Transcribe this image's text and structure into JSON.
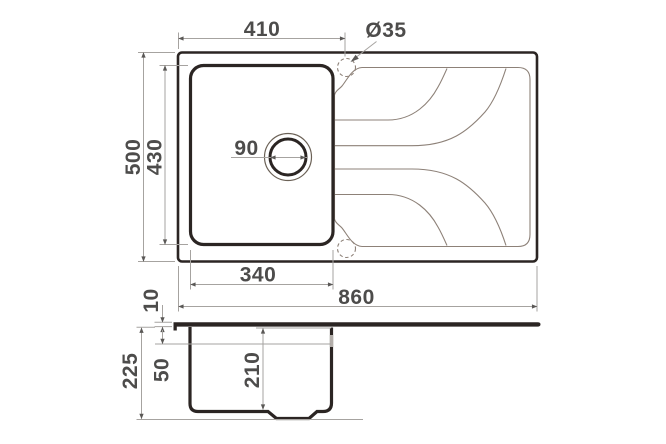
{
  "drawing": {
    "subject": "sink-technical-drawing",
    "views": {
      "plan": "top-view",
      "section": "side-view"
    }
  },
  "colors": {
    "outline": "#2b2523",
    "thin_line": "#8d8178",
    "dimension_line": "#a6a3a0",
    "dimension_text": "#4d4c4b",
    "background": "#ffffff"
  },
  "dims": {
    "faucet_offset": "410",
    "faucet_hole_dia": "Ø35",
    "outer_depth": "500",
    "bowl_depth_plan": "430",
    "drain_dia": "90",
    "bowl_width": "340",
    "outer_width": "860",
    "rim_thickness": "10",
    "rim_to_overflow": "50",
    "total_height": "225",
    "bowl_inner_height": "210"
  }
}
